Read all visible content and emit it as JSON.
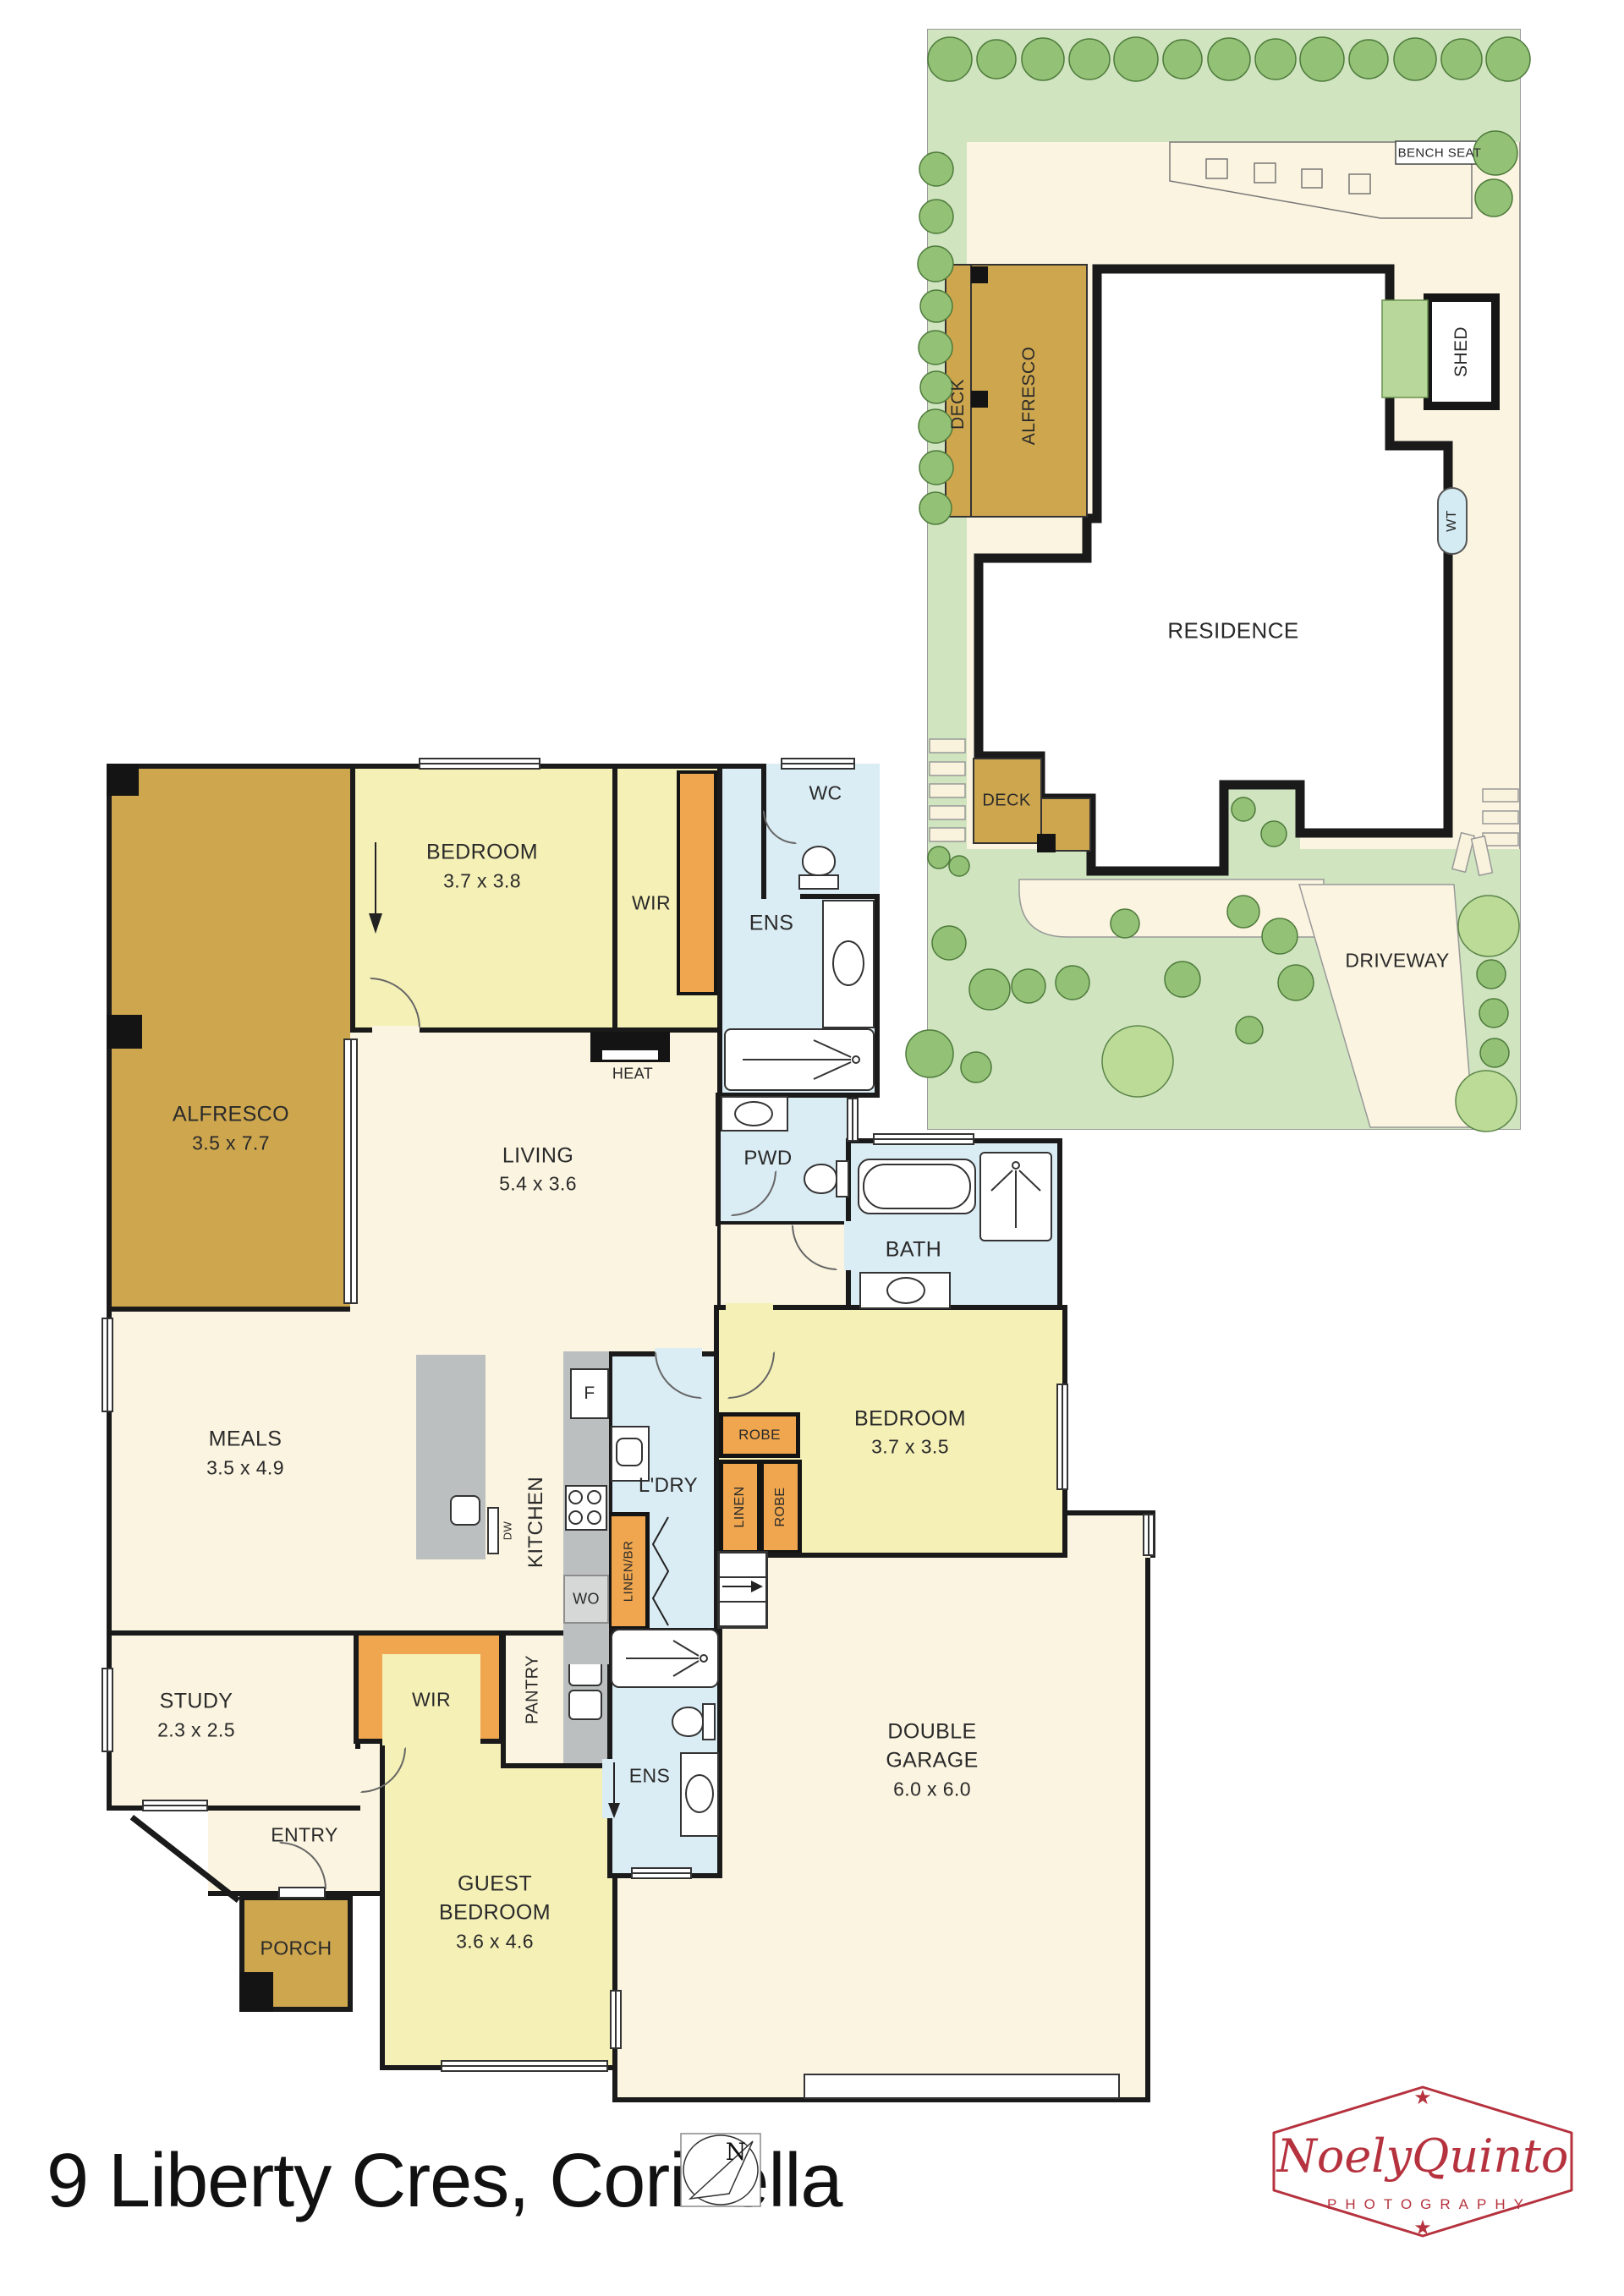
{
  "title": "9 Liberty Cres, Corinella",
  "compass": {
    "north": "N"
  },
  "logo": {
    "script": "NoelyQuinto",
    "subtitle": "PHOTOGRAPHY"
  },
  "site": {
    "bench_seat": "BENCH SEAT",
    "deck_upper": "DECK",
    "alfresco": "ALFRESCO",
    "shed": "SHED",
    "water_tank": "WT",
    "residence": "RESIDENCE",
    "deck_lower": "DECK",
    "driveway": "DRIVEWAY"
  },
  "rooms": {
    "bedroom1": {
      "name": "BEDROOM",
      "dims": "3.7 x 3.8"
    },
    "wir1": {
      "name": "WIR"
    },
    "wc": {
      "name": "WC"
    },
    "ens1": {
      "name": "ENS"
    },
    "alfresco": {
      "name": "ALFRESCO",
      "dims": "3.5 x 7.7"
    },
    "heat": {
      "name": "HEAT"
    },
    "living": {
      "name": "LIVING",
      "dims": "5.4 x 3.6"
    },
    "pwd": {
      "name": "PWD"
    },
    "bath": {
      "name": "BATH"
    },
    "meals": {
      "name": "MEALS",
      "dims": "3.5 x 4.9"
    },
    "kitchen": {
      "name": "KITCHEN"
    },
    "fridge": {
      "name": "F"
    },
    "dishwasher": {
      "name": "DW"
    },
    "wall_oven": {
      "name": "WO"
    },
    "laundry": {
      "name": "L'DRY"
    },
    "robe_top": {
      "name": "ROBE"
    },
    "linen": {
      "name": "LINEN"
    },
    "robe_side": {
      "name": "ROBE"
    },
    "linen_br": {
      "name": "LINEN/BR"
    },
    "bedroom2": {
      "name": "BEDROOM",
      "dims": "3.7 x 3.5"
    },
    "study": {
      "name": "STUDY",
      "dims": "2.3 x 2.5"
    },
    "wir2": {
      "name": "WIR"
    },
    "pantry": {
      "name": "PANTRY"
    },
    "ens2": {
      "name": "ENS"
    },
    "entry": {
      "name": "ENTRY"
    },
    "porch": {
      "name": "PORCH"
    },
    "guest_bedroom": {
      "line1": "GUEST",
      "line2": "BEDROOM",
      "dims": "3.6 x 4.6"
    },
    "garage": {
      "line1": "DOUBLE",
      "line2": "GARAGE",
      "dims": "6.0 x 6.0"
    }
  },
  "colors": {
    "floor_cream": "#fbf4e0",
    "bedroom_yellow": "#f5f0b6",
    "wet_blue": "#daecf4",
    "robe_orange": "#efa64e",
    "deck_gold": "#cda64e",
    "bench_gray": "#bcbfc0",
    "lawn_green": "#cfe4bf",
    "tree_green": "#93c176",
    "logo_red": "#b5323e",
    "wall": "#1a1a1a"
  }
}
